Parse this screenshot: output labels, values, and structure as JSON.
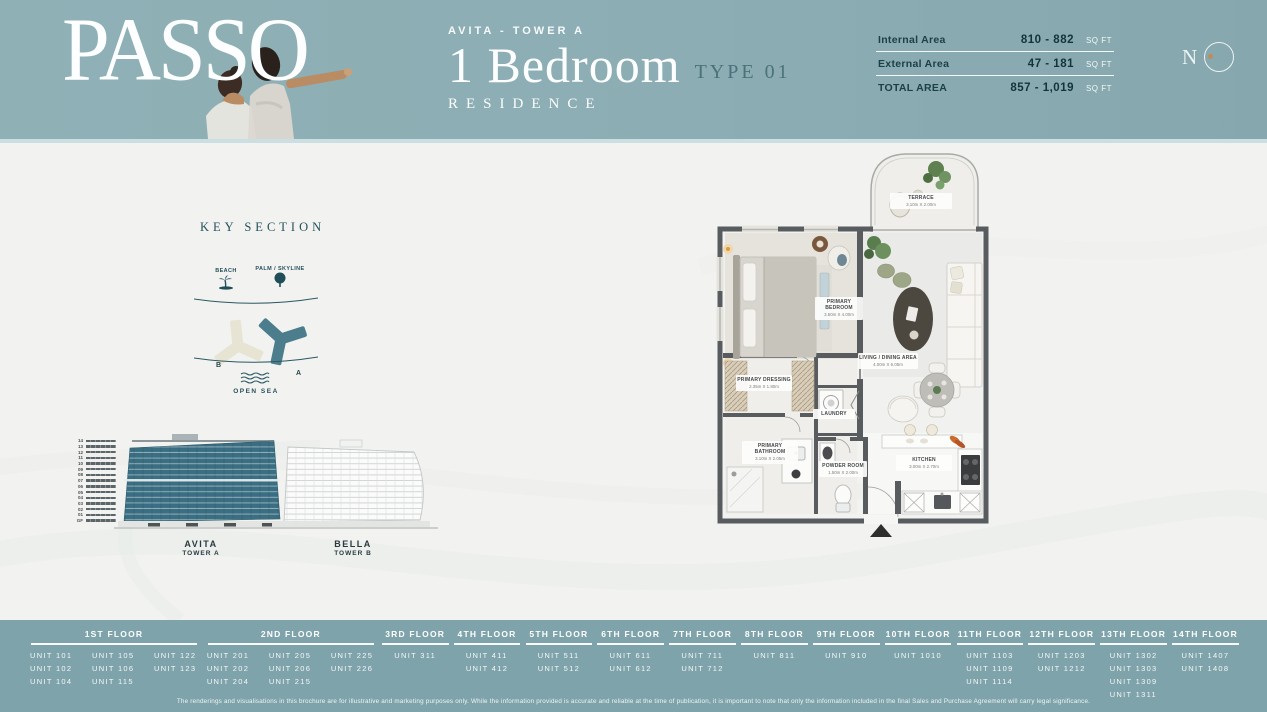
{
  "header": {
    "brand": "PASSO",
    "tower_label": "AVITA - TOWER A",
    "unit_type": "1 Bedroom",
    "type_label": "TYPE 01",
    "residence_label": "RESIDENCE",
    "compass_label": "N",
    "areas": [
      {
        "label": "Internal Area",
        "value": "810 - 882",
        "unit": "SQ FT"
      },
      {
        "label": "External Area",
        "value": "47 - 181",
        "unit": "SQ FT"
      },
      {
        "label": "TOTAL AREA",
        "value": "857 - 1,019",
        "unit": "SQ FT"
      }
    ]
  },
  "key_section": {
    "title": "KEY SECTION",
    "beach_label": "BEACH",
    "palm_label": "PALM / SKYLINE",
    "tower_b_letter": "B",
    "tower_a_letter": "A",
    "open_sea_label": "OPEN SEA"
  },
  "elevation": {
    "levels": [
      "14",
      "13",
      "12",
      "11",
      "10",
      "09",
      "08",
      "07",
      "06",
      "05",
      "04",
      "03",
      "02",
      "01",
      "GF"
    ],
    "towers": [
      {
        "name": "AVITA",
        "sub": "TOWER A"
      },
      {
        "name": "BELLA",
        "sub": "TOWER B"
      }
    ]
  },
  "floor_plan": {
    "rooms": [
      {
        "name": "TERRACE",
        "dims": "3.10m X 2.00m"
      },
      {
        "name": "PRIMARY BEDROOM",
        "dims": "3.50m X 4.00m"
      },
      {
        "name": "LIVING / DINING AREA",
        "dims": "4.00m X 6.05m"
      },
      {
        "name": "PRIMARY DRESSING",
        "dims": "2.35m X 1.80m"
      },
      {
        "name": "LAUNDRY",
        "dims": ""
      },
      {
        "name": "PRIMARY BATHROOM",
        "dims": "3.10m X 2.05m"
      },
      {
        "name": "POWDER ROOM",
        "dims": "1.50m X 2.00m"
      },
      {
        "name": "KITCHEN",
        "dims": "3.00m X 2.70m"
      }
    ]
  },
  "floors": [
    {
      "label": "1ST FLOOR",
      "wide": true,
      "columns": [
        [
          "UNIT 101",
          "UNIT 102",
          "UNIT 104"
        ],
        [
          "UNIT 105",
          "UNIT 106",
          "UNIT 115"
        ],
        [
          "UNIT 122",
          "UNIT 123"
        ]
      ]
    },
    {
      "label": "2ND FLOOR",
      "wide": true,
      "columns": [
        [
          "UNIT 201",
          "UNIT 202",
          "UNIT 204"
        ],
        [
          "UNIT 205",
          "UNIT 206",
          "UNIT 215"
        ],
        [
          "UNIT 225",
          "UNIT 226"
        ]
      ]
    },
    {
      "label": "3RD FLOOR",
      "wide": false,
      "columns": [
        [
          "UNIT 311"
        ]
      ]
    },
    {
      "label": "4TH FLOOR",
      "wide": false,
      "columns": [
        [
          "UNIT 411",
          "UNIT 412"
        ]
      ]
    },
    {
      "label": "5TH FLOOR",
      "wide": false,
      "columns": [
        [
          "UNIT 511",
          "UNIT 512"
        ]
      ]
    },
    {
      "label": "6TH FLOOR",
      "wide": false,
      "columns": [
        [
          "UNIT 611",
          "UNIT 612"
        ]
      ]
    },
    {
      "label": "7TH FLOOR",
      "wide": false,
      "columns": [
        [
          "UNIT 711",
          "UNIT 712"
        ]
      ]
    },
    {
      "label": "8TH FLOOR",
      "wide": false,
      "columns": [
        [
          "UNIT 811"
        ]
      ]
    },
    {
      "label": "9TH FLOOR",
      "wide": false,
      "columns": [
        [
          "UNIT 910"
        ]
      ]
    },
    {
      "label": "10TH FLOOR",
      "wide": false,
      "columns": [
        [
          "UNIT 1010"
        ]
      ]
    },
    {
      "label": "11TH FLOOR",
      "wide": false,
      "columns": [
        [
          "UNIT 1103",
          "UNIT 1109",
          "UNIT 1114"
        ]
      ]
    },
    {
      "label": "12TH FLOOR",
      "wide": false,
      "columns": [
        [
          "UNIT 1203",
          "UNIT 1212"
        ]
      ]
    },
    {
      "label": "13TH FLOOR",
      "wide": false,
      "columns": [
        [
          "UNIT 1302",
          "UNIT 1303",
          "UNIT 1309",
          "UNIT 1311"
        ]
      ]
    },
    {
      "label": "14TH FLOOR",
      "wide": false,
      "columns": [
        [
          "UNIT 1407",
          "UNIT 1408"
        ]
      ]
    }
  ],
  "disclaimer": "The renderings and visualisations in this brochure are for illustrative and marketing purposes only. While the information provided is accurate and reliable at the time of publication, it is important to note that only the information included in the final Sales and Purchase Agreement will carry legal significance.",
  "colors": {
    "header_teal": "#8caeb4",
    "footer_teal": "#7fa3aa",
    "dark_teal_text": "#23505b",
    "tower_a_teal": "#3a6e82",
    "tower_b_beige": "#e8e4d4",
    "compass_dot_tan": "#c08d5a"
  }
}
